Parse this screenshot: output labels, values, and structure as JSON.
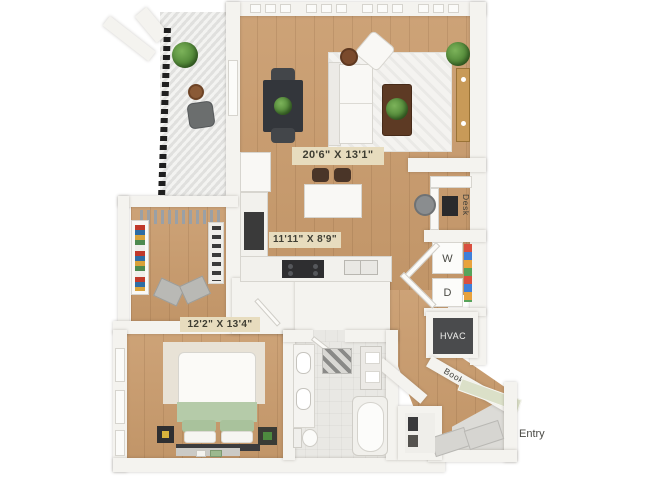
{
  "plan": {
    "living_room": {
      "dimensions": "20'6\" X 13'1\""
    },
    "kitchen": {
      "dimensions": "11'11\" X 8'9\""
    },
    "bedroom": {
      "dimensions": "12'2\" X 13'4\""
    },
    "labels": {
      "desk": "Desk",
      "washer": "W",
      "dryer": "D",
      "hvac": "HVAC",
      "bookshelf": "Bookshelf",
      "entry": "Entry"
    },
    "colors": {
      "wood_floor": "#c99b6c",
      "wall": "#f4f3ef",
      "bath_floor": "#e9e8e4",
      "hvac_unit": "#4a4b4d",
      "dimension_chip_bg": "#e7dcbe",
      "dimension_text": "#3f3e33",
      "bed_blanket_green": "#b5cba9",
      "bookshelf_top_green": "#dbe0c8",
      "balcony_deck_stripe": "#dfdfdd"
    }
  }
}
